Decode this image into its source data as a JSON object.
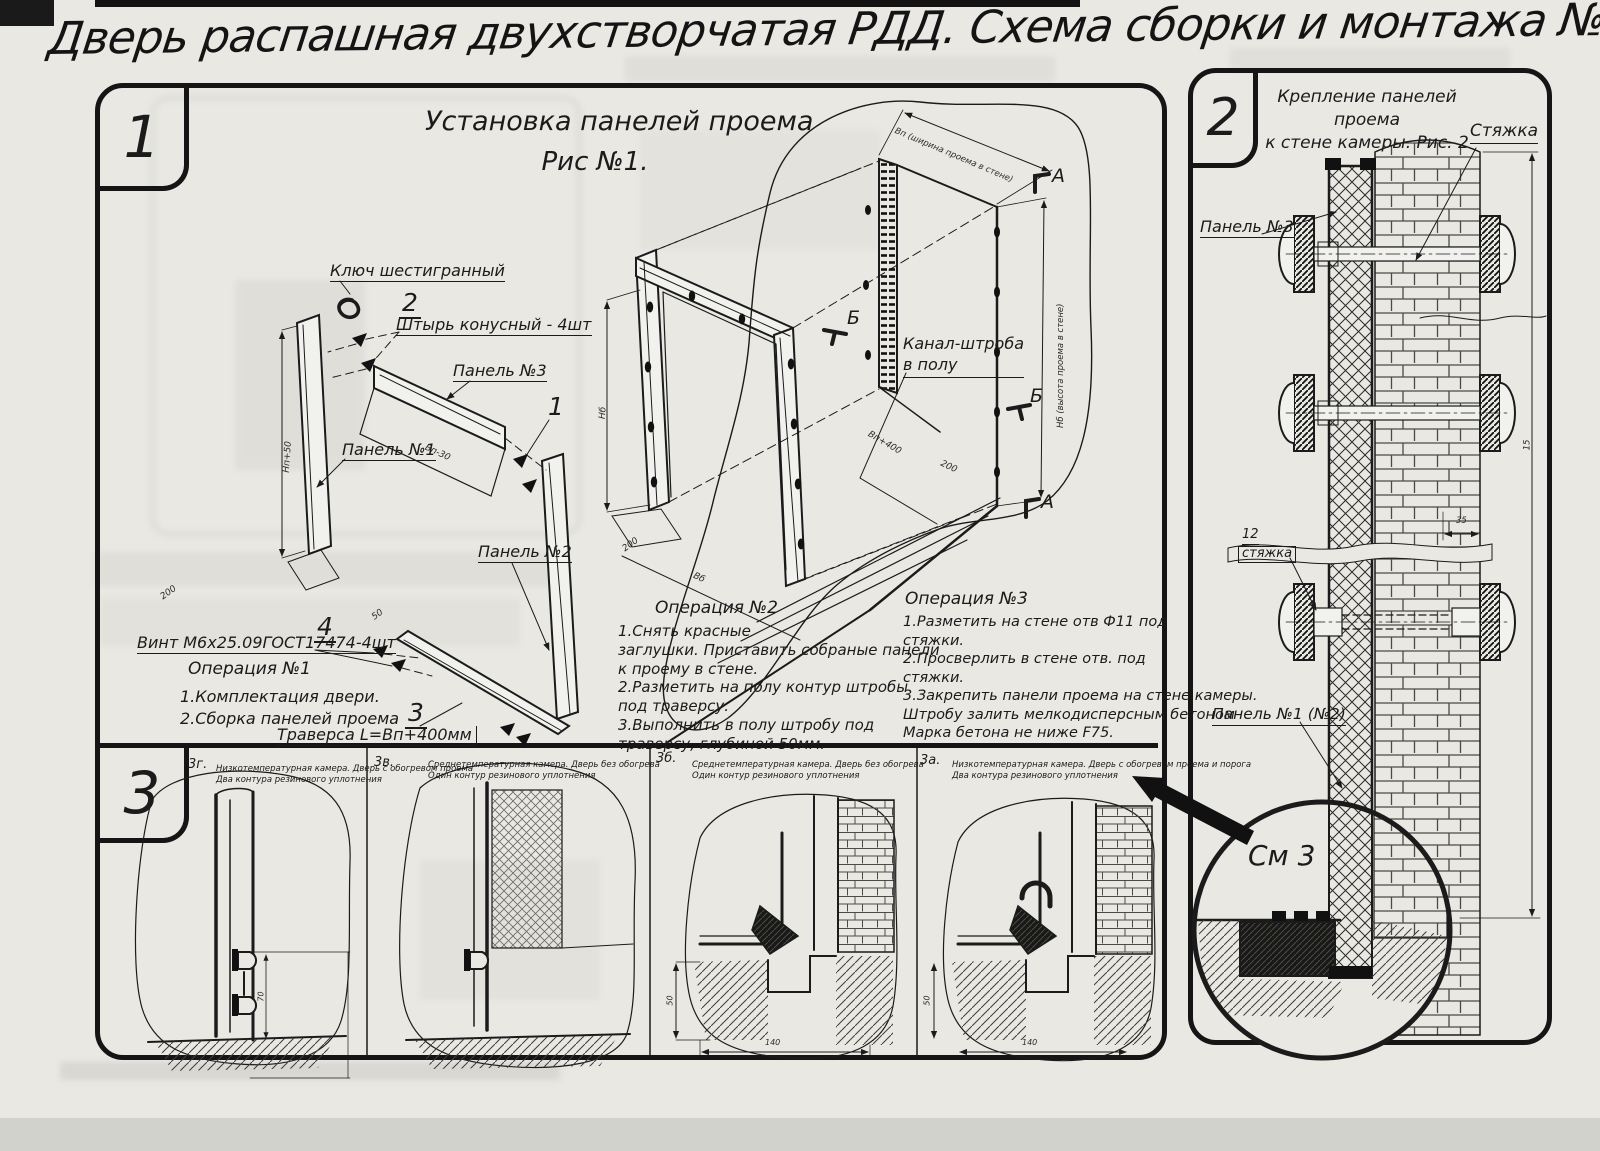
{
  "colors": {
    "paper": "#e9e8e3",
    "ink": "#1b1b1b"
  },
  "title": "Дверь распашная двухстворчатая РДД.  Схема сборки и монтажа №2",
  "s1": {
    "num": "1",
    "fig_title": "Установка панелей проема",
    "fig_sub": "Рис №1.",
    "hex_key": "Ключ шестигранный",
    "callout_pin": "2",
    "pin": "Штырь конусный - 4шт",
    "panel3": "Панель №3",
    "callout_panel": "1",
    "panel1": "Панель №1",
    "panel2": "Панель №2",
    "callout_screw": "4",
    "screw": "Винт М6х25.09ГОСТ17474-4шт",
    "callout_traverse": "3",
    "traverse": "Траверса  L=Вп+400мм",
    "channel": "Канал-штроба\nв полу",
    "op1_title": "Операция №1",
    "op1": "1.Комплектация двери.\n2.Сборка панелей проема",
    "op2_title": "Операция №2",
    "op2": "1.Снять красные\nзаглушки. Приставить собраные панели\nк проему в стене.\n2.Разметить на полу контур штробы\nпод траверсу.\n3.Выполнить в полу штробу под\nтраверсу, глубиной 50мм.",
    "op3_title": "Операция №3",
    "op3": "1.Разметить на стене отв Ф11 под\nстяжки.\n2.Просверлить в стене отв.  под\nстяжки.\n3.Закрепить панели проема на стене камеры.\nШтробу залить мелкодисперсным бетоном\nМарка бетона не ниже  F75.",
    "dim_width": "Вп (ширина проема в стене)",
    "dim_height": "Нб (высота проема в стене)",
    "marker_a": "А",
    "marker_b": "Б",
    "dims": {
      "hp50": "Нп+50",
      "d200": "200",
      "vp30": "Вп-30",
      "d50": "50",
      "hb": "Нб",
      "vb": "Вб",
      "vp400": "Вп+400"
    }
  },
  "s2": {
    "num": "2",
    "title": "Крепление панелей проема\nк стене камеры. Рис. 2",
    "tie": "Стяжка",
    "panel3": "Панель №3",
    "pos12": "12",
    "pos12_name": "стяжка",
    "panel12": "Панель №1 (№2)",
    "see": "См 3",
    "dim35": "35",
    "dim15": "15"
  },
  "s3": {
    "num": "3",
    "panels": [
      {
        "code": "3г.",
        "desc": "Низкотемпературная камера. Дверь с обогревом проема\nДва контура резинового уплотнения",
        "dim_v": "70",
        "dim_h": ""
      },
      {
        "code": "3в.",
        "desc": "Среднетемпературная камера. Дверь без обогрева\nОдин контур резинового уплотнения",
        "dim_v": "",
        "dim_h": ""
      },
      {
        "code": "3б.",
        "desc": "Среднетемпературная камера. Дверь без обогрева\nОдин контур резинового уплотнения",
        "dim_v": "50",
        "dim_h": "140"
      },
      {
        "code": "3а.",
        "desc": "Низкотемпературная камера. Дверь с обогревом проема и порога\nДва контура резинового уплотнения",
        "dim_v": "50",
        "dim_h": "140"
      }
    ]
  }
}
